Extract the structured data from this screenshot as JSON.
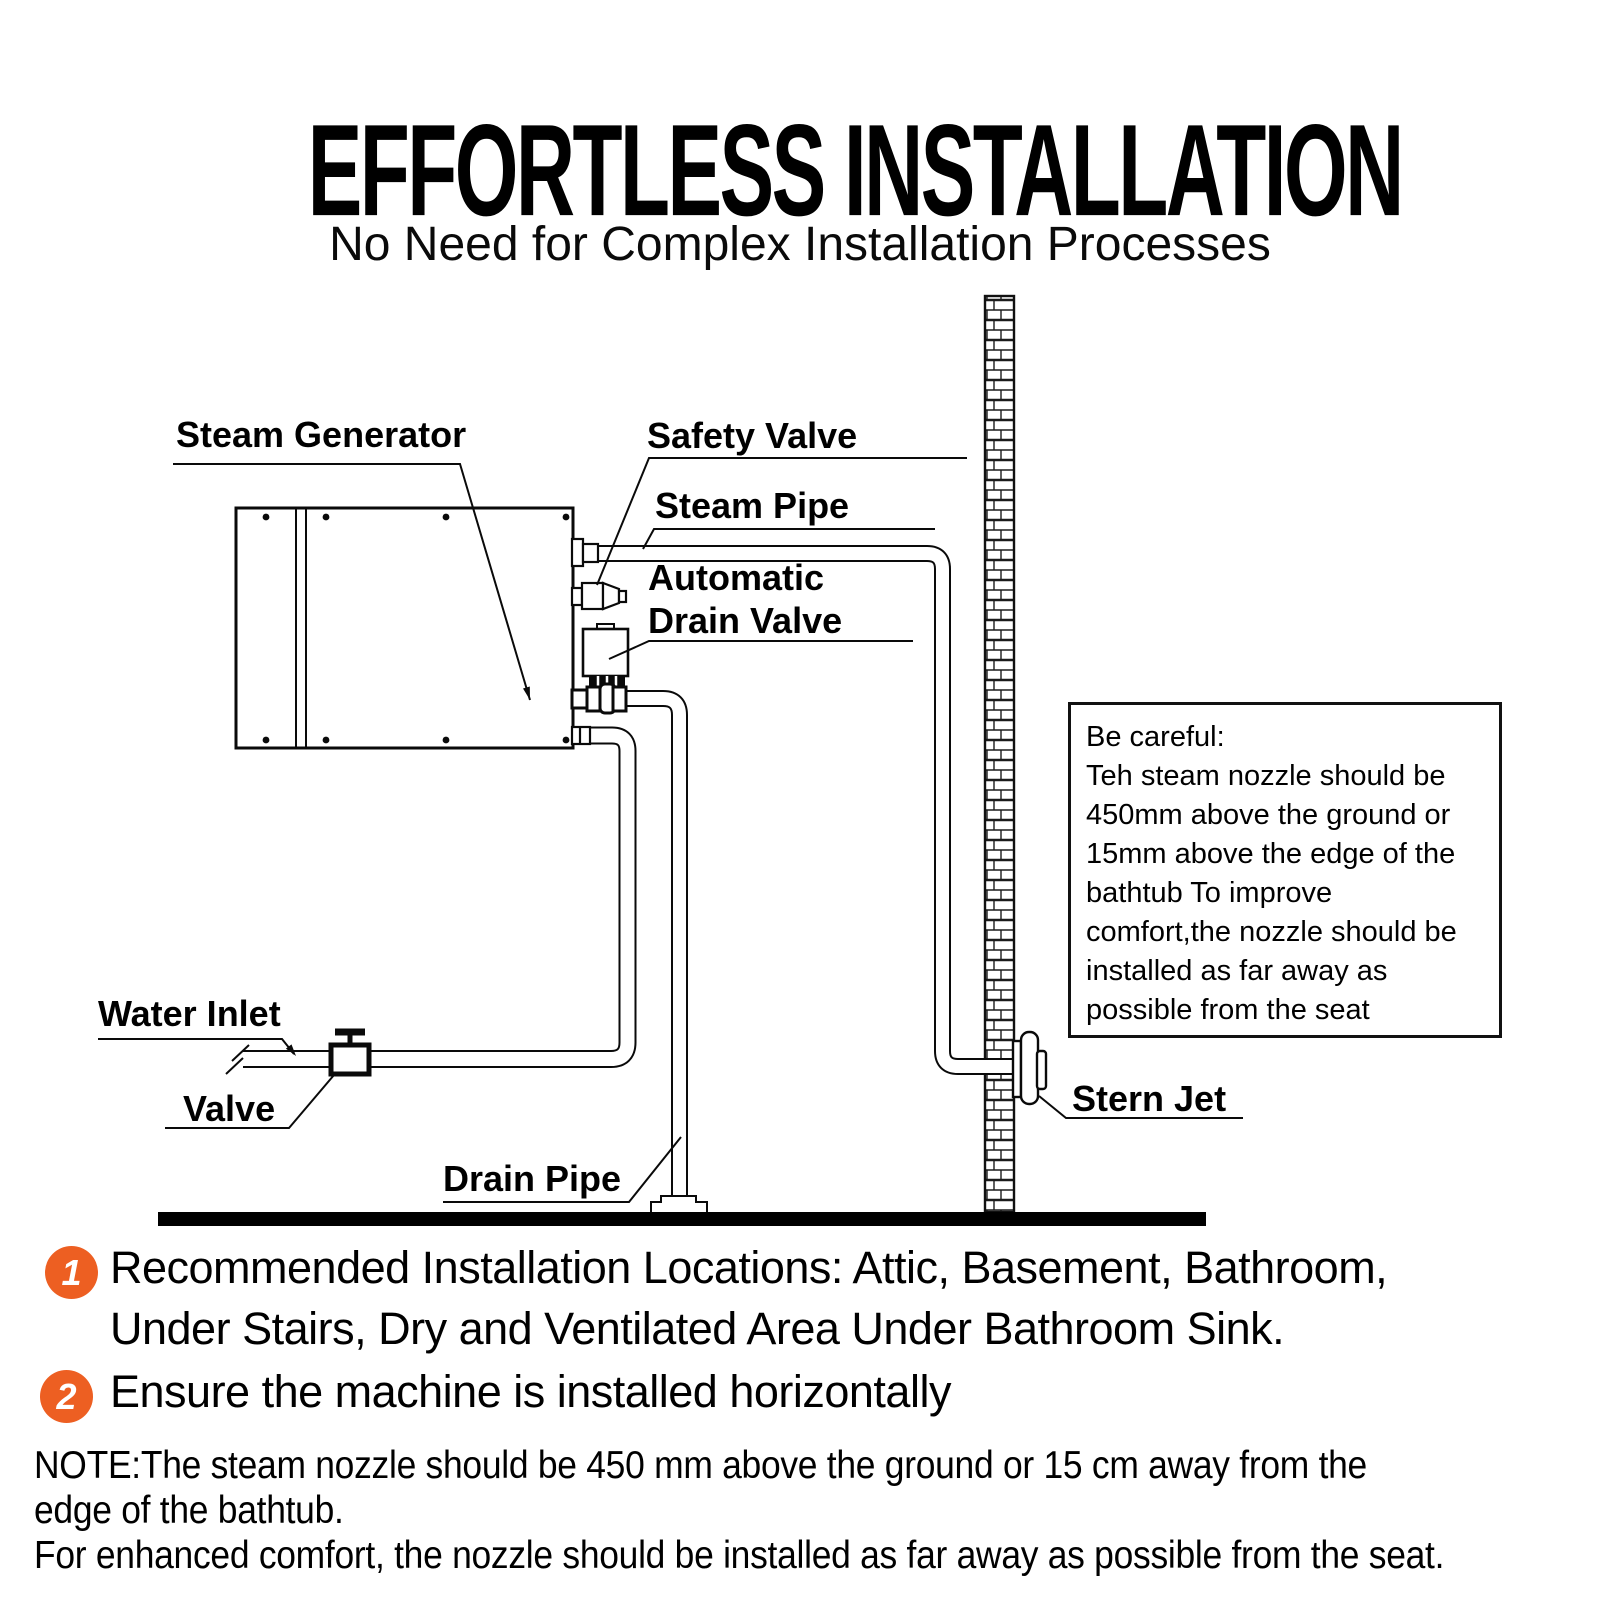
{
  "header": {
    "title": "EFFORTLESS INSTALLATION",
    "subtitle": "No Need for Complex Installation Processes"
  },
  "diagram": {
    "labels": {
      "steam_generator": "Steam Generator",
      "safety_valve": "Safety Valve",
      "steam_pipe": "Steam Pipe",
      "automatic_drain_valve_line1": "Automatic",
      "automatic_drain_valve_line2": "Drain Valve",
      "water_inlet": "Water Inlet",
      "valve": "Valve",
      "drain_pipe": "Drain Pipe",
      "stern_jet": "Stern Jet"
    },
    "caution_box": {
      "lines": [
        "Be careful:",
        "Teh steam nozzle should be",
        "450mm above  the ground or",
        "15mm above the edge of the",
        "bathtub To improve",
        "comfort,the nozzle should be",
        "installed as far away as",
        "possible from the seat"
      ]
    }
  },
  "notes": {
    "accent_color": "#ED5F22",
    "items": [
      {
        "number": "1",
        "lines": [
          "Recommended Installation Locations: Attic, Basement, Bathroom,",
          "Under Stairs, Dry and Ventilated Area Under Bathroom Sink."
        ]
      },
      {
        "number": "2",
        "lines": [
          "Ensure the machine is installed horizontally"
        ]
      }
    ],
    "footnote_lines": [
      "NOTE:The steam nozzle should be 450 mm above the ground or 15 cm away from the",
      "edge of the bathtub.",
      "For enhanced comfort, the nozzle should be installed as far away as possible from the seat."
    ]
  }
}
